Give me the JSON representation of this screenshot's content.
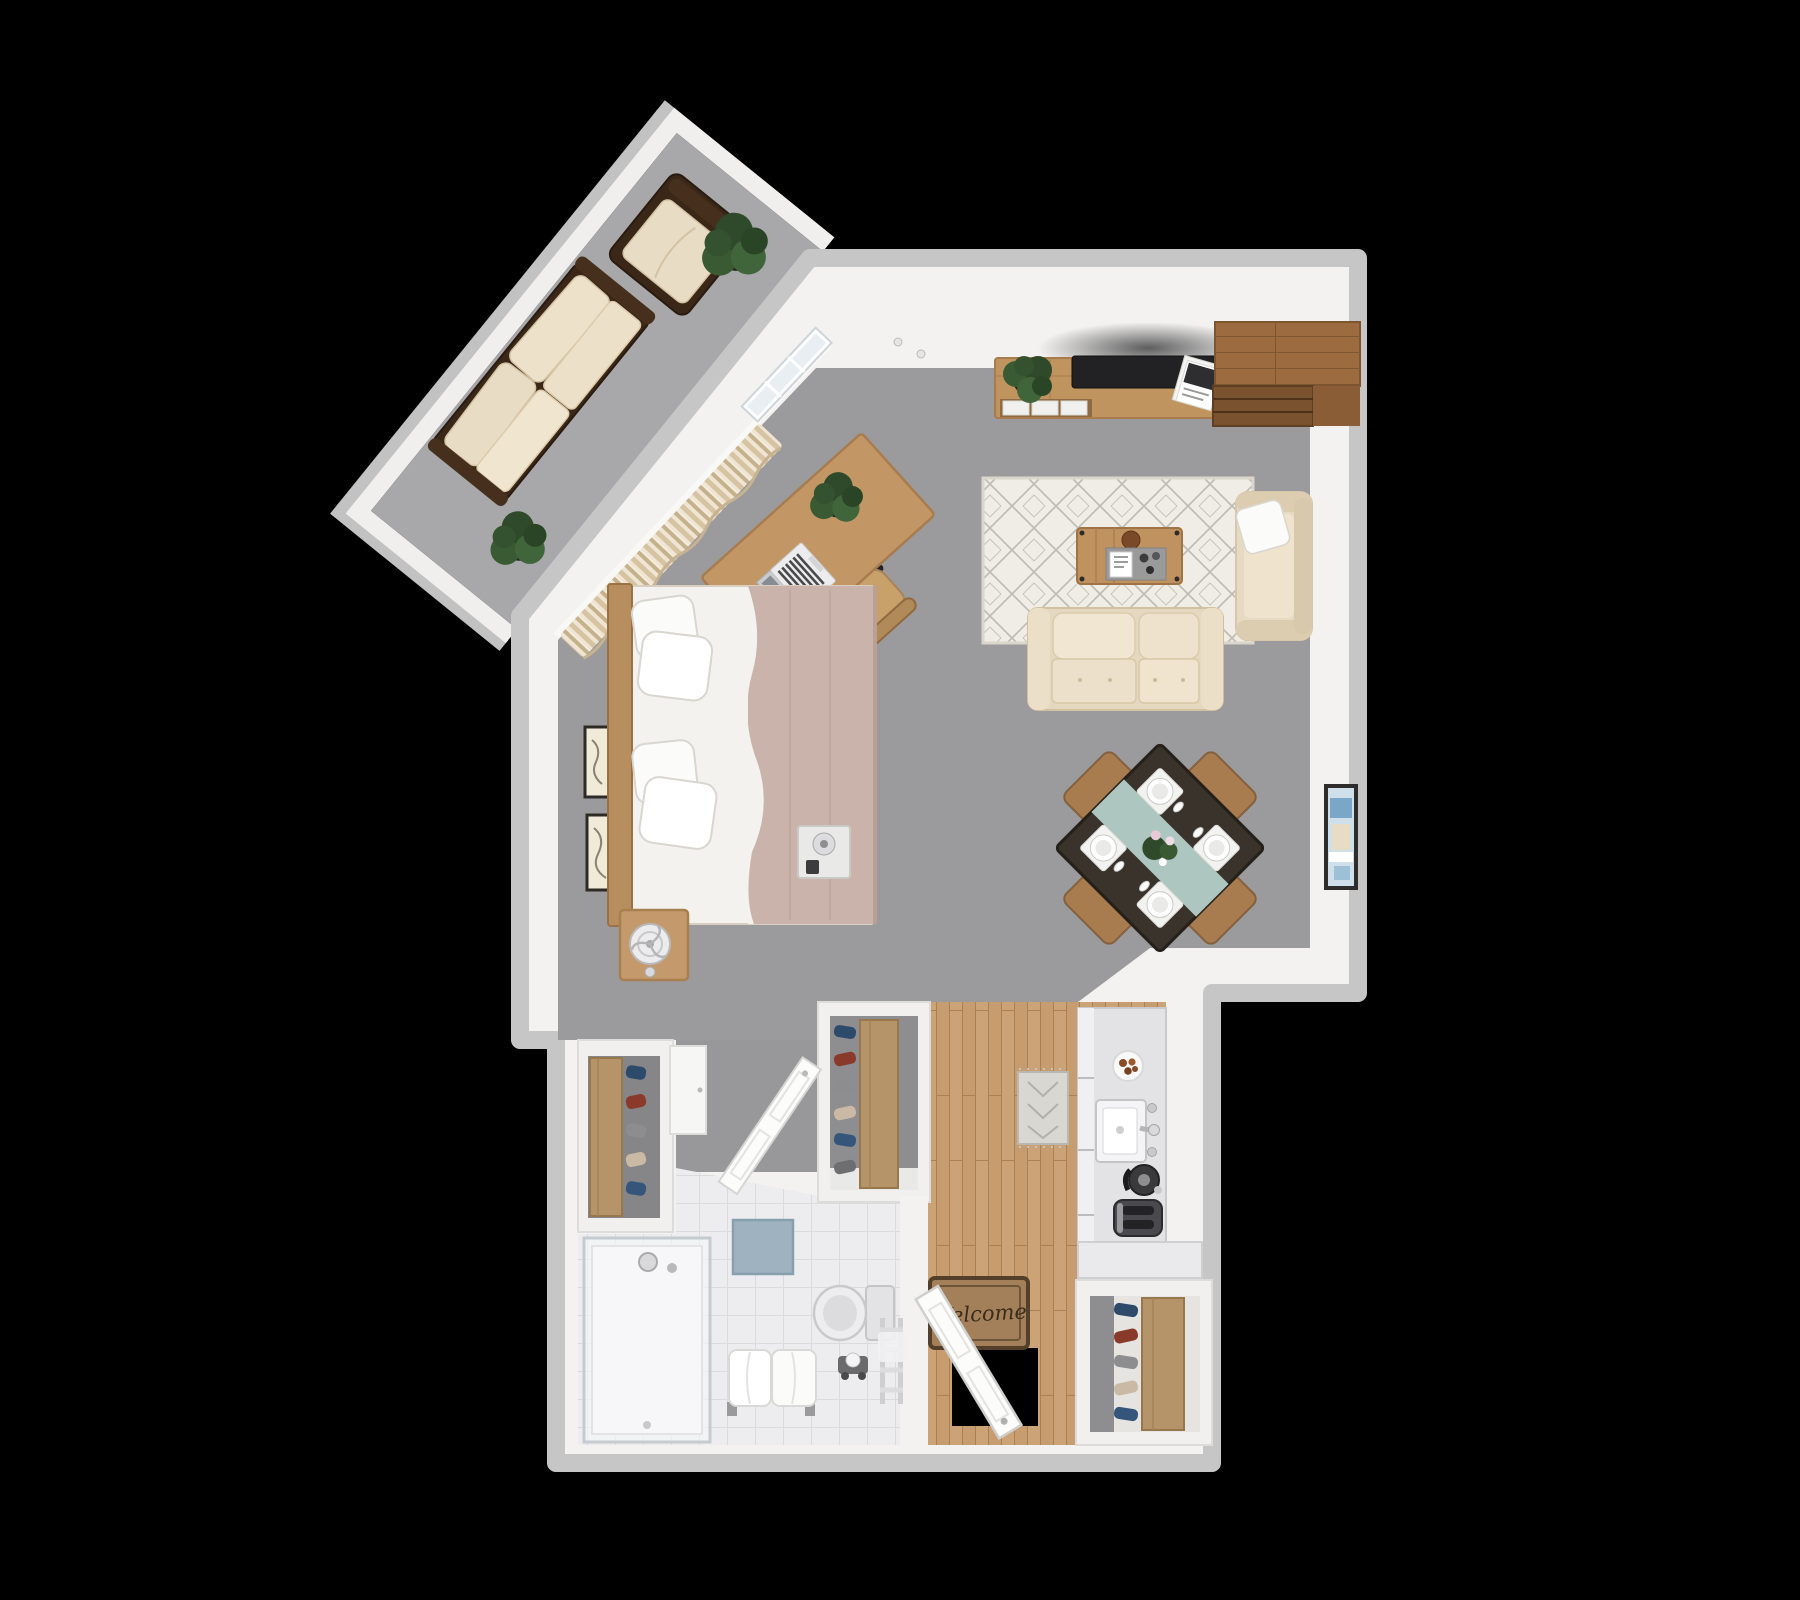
{
  "scene": {
    "title": "3D top-down floor plan render of a studio apartment",
    "view": "bird's-eye 3D render on black background"
  },
  "entry": {
    "welcome_mat_text": "Welcome"
  },
  "colors": {
    "background": "#000000",
    "wall": "#f3f2f0",
    "wall_edge": "#c6c6c6",
    "carpet": "#9b9b9d",
    "balcony_floor": "#a8a8aa",
    "wood_floor": "#c79d6f",
    "tile": "#ededef",
    "rug_base": "#efede5",
    "rug_pattern": "#bdbbb2",
    "sofa_fabric": "#e9dcc5",
    "outdoor_frame": "#3a2718",
    "wood_light": "#c39765",
    "wood_medium": "#a97c50",
    "wood_dark": "#9c6b3f",
    "bed_blanket": "#c9b3ab",
    "linens": "#f7f5f1",
    "dining_table_top": "#3a332c",
    "runner_teal": "#b7d2cc",
    "plant_green": "#3a5a33",
    "appliance_dark": "#3f3f42",
    "mat_brown": "#a3805a",
    "mat_text": "#3a2c1a",
    "art_blue": "#7aa7c7",
    "bath_mat_blue": "#9fb2bf"
  },
  "closets": {
    "shoe_colors": [
      "#2e4a6b",
      "#8a3a2a",
      "#8d8d8f",
      "#c9b9a5",
      "#35557a",
      "#6e6e70"
    ]
  },
  "rooms": [
    {
      "name": "Balcony",
      "floor": "concrete"
    },
    {
      "name": "Living Room",
      "floor": "carpet"
    },
    {
      "name": "Dining Area",
      "floor": "carpet"
    },
    {
      "name": "Bedroom Area",
      "floor": "carpet"
    },
    {
      "name": "Office Nook",
      "floor": "carpet"
    },
    {
      "name": "Kitchen",
      "floor": "wood"
    },
    {
      "name": "Bathroom",
      "floor": "tile"
    },
    {
      "name": "Entry",
      "floor": "wood"
    },
    {
      "name": "Closets",
      "floor": "mixed"
    }
  ],
  "inventory": {
    "balcony": [
      "outdoor-sofa",
      "outdoor-armchair",
      "potted-plant-large",
      "potted-plant-small"
    ],
    "living_room": [
      "tv-console",
      "tv",
      "console-plant",
      "magazine-stack",
      "corner-wardrobe",
      "area-rug",
      "coffee-table",
      "serving-tray",
      "sofa",
      "accent-armchair",
      "throw-pillow",
      "framed-wall-art"
    ],
    "dining": [
      "dining-table",
      "dining-chairs-x4",
      "place-settings-x4",
      "centerpiece-flowers",
      "table-runner"
    ],
    "bedroom": [
      "bed",
      "pillows-x4",
      "headboard",
      "nightstand",
      "table-fan",
      "wall-art-x2",
      "bed-tray-speaker"
    ],
    "office": [
      "desk",
      "laptop",
      "desk-plant",
      "office-chair",
      "curtains",
      "sliding-glass-door"
    ],
    "kitchen": [
      "kitchen-counter",
      "food-plate",
      "sink",
      "faucet",
      "kettle",
      "toaster",
      "kitchen-rug"
    ],
    "bathroom": [
      "shower",
      "shower-head",
      "towel-bench",
      "toilet",
      "toilet-paper-stand",
      "towel-ladder",
      "bath-mat"
    ],
    "entry": [
      "welcome-mat",
      "entry-door",
      "doorway-void",
      "hall-cabinet"
    ],
    "closets": [
      "shoe-shelf-1",
      "shoe-shelf-2",
      "shoe-shelf-3",
      "bathroom-door"
    ]
  }
}
